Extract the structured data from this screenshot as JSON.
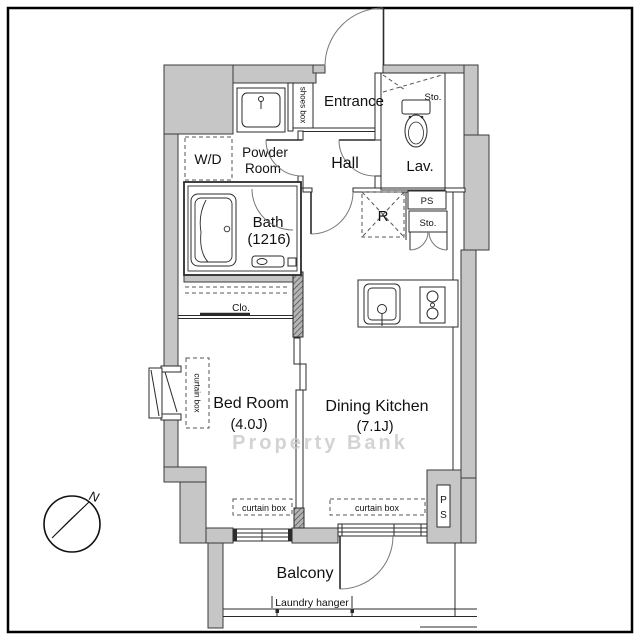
{
  "colors": {
    "wall": "#c6c6c6",
    "line": "#2b2b2b",
    "watermark": "#c9c9c9",
    "background": "#ffffff"
  },
  "labels": {
    "entrance": "Entrance",
    "shoes_box": "shoes box",
    "sto_top": "Sto.",
    "wd": "W/D",
    "powder_1": "Powder",
    "powder_2": "Room",
    "hall": "Hall",
    "lav": "Lav.",
    "bath_1": "Bath",
    "bath_2": "(1216)",
    "fridge": "R",
    "ps": "PS",
    "sto": "Sto.",
    "clo": "Clo.",
    "curtain_left": "curtain box",
    "bed_1": "Bed Room",
    "bed_2": "(4.0J)",
    "dk_1": "Dining Kitchen",
    "dk_2": "(7.1J)",
    "curtain_bed": "curtain box",
    "curtain_dk": "curtain box",
    "ps_vertical_p": "P",
    "ps_vertical_s": "S",
    "balcony": "Balcony",
    "laundry": "Laundry hanger",
    "north": "N",
    "watermark": "Property Bank"
  }
}
